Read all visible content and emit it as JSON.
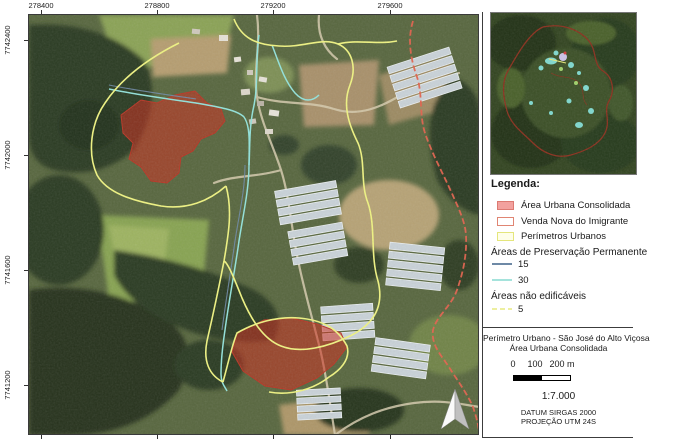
{
  "map": {
    "top_labels": [
      "278400",
      "278800",
      "279200",
      "279600"
    ],
    "left_labels": [
      "7742400",
      "7742000",
      "7741600",
      "7741200"
    ]
  },
  "legend": {
    "heading": "Legenda:",
    "items": [
      {
        "label": "Área Urbana Consolidada",
        "fill": "#F2A19E",
        "stroke": "#DC7A72"
      },
      {
        "label": "Venda Nova do Imigrante",
        "fill": "#FFFFFF",
        "stroke": "#E08573"
      },
      {
        "label": "Perímetros Urbanos",
        "fill": "#FEFEE9",
        "stroke": "#E4E67C"
      }
    ],
    "groups": [
      {
        "heading": "Áreas de Preservação Permanente",
        "items": [
          {
            "label": "15",
            "color": "#6E89A6"
          },
          {
            "label": "30",
            "color": "#A5E3DC"
          }
        ]
      },
      {
        "heading": "Áreas não edificáveis",
        "items": [
          {
            "label": "5",
            "color": "#EDEFA0"
          }
        ]
      }
    ]
  },
  "title_block": {
    "line1": "Perímetro Urbano - São José do Alto Viçosa",
    "line2": "Área Urbana Consolidada",
    "scalebar_labels": [
      "0",
      "100",
      "200 m"
    ],
    "scale_ratio": "1:7.000",
    "datum": "DATUM SIRGAS 2000",
    "projection": "PROJEÇÃO UTM 24S"
  },
  "overlay_colors": {
    "urban_consolidated_fill": "#CD2B1E",
    "urban_perimeter_yellow": "#EFF381",
    "app_15_blue": "#6E89A6",
    "app_30_cyan": "#92E2DA",
    "municipal_boundary_red": "#E2614C"
  }
}
